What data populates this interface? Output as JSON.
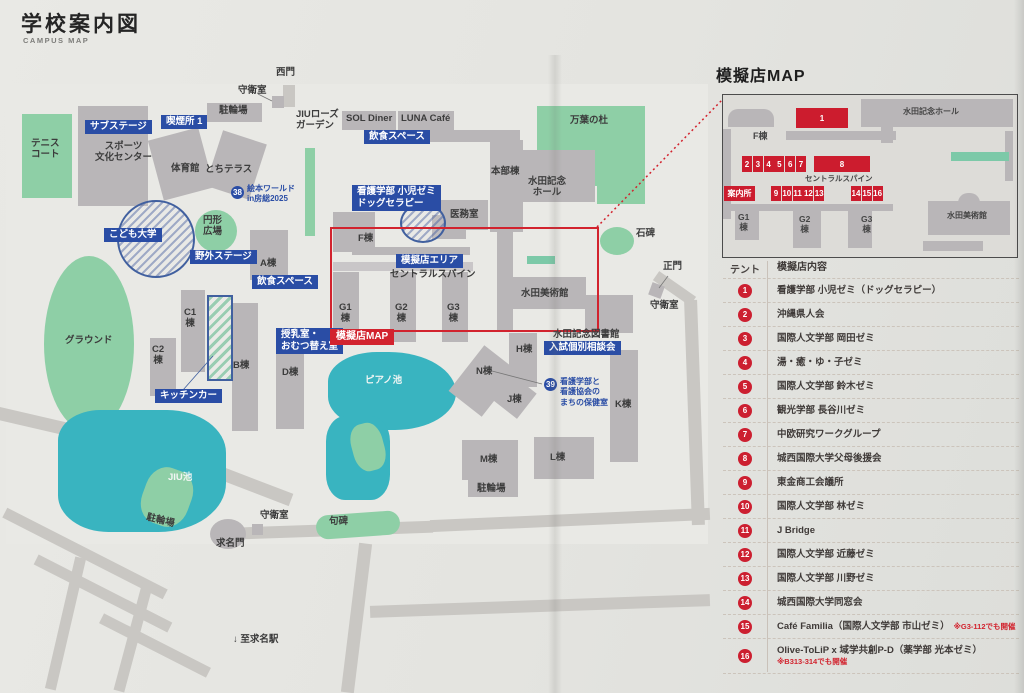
{
  "header": {
    "title": "学校案内図",
    "subtitle": "CAMPUS MAP"
  },
  "colors": {
    "accent_red": "#d2232e",
    "label_blue": "#2a4da5",
    "building_gray": "#b9b6b8",
    "green": "#8ecfa6",
    "pond_teal": "#39b4c0"
  },
  "map": {
    "t": [
      "西門",
      "守衛室",
      "駐輪場",
      "JIUローズ\nガーデン",
      "SOL Diner",
      "LUNA Café",
      "万葉の杜",
      "本部棟",
      "水田記念\nホール",
      "医務室",
      "テニス\nコート",
      "スポーツ\n文化センター",
      "体育館",
      "とちテラス",
      "円形\n広場",
      "A棟",
      "F棟",
      "セントラルスパイン",
      "G1\n棟",
      "G2\n棟",
      "G3\n棟",
      "水田美術館",
      "石碑",
      "正門",
      "守衛室",
      "水田記念図書館",
      "H棟",
      "C1\n棟",
      "C2\n棟",
      "B棟",
      "D棟",
      "グラウンド",
      "ピアノ池",
      "N棟",
      "J棟",
      "K棟",
      "M棟",
      "L棟",
      "駐輪場",
      "JIU池",
      "駐輪場",
      "守衛室",
      "求名門",
      "句碑",
      "↓ 至求名駅"
    ],
    "blue": [
      "サブステージ",
      "喫煙所 1",
      "飲食スペース",
      "看護学部 小児ゼミ\nドッグセラピー",
      "こども大学",
      "野外ステージ",
      "飲食スペース",
      "模擬店エリア",
      "授乳室・\nおむつ替え室",
      "キッチンカー",
      "入試個別相談会"
    ],
    "rl": "模擬店MAP",
    "b38": {
      "num": "38",
      "text": "絵本ワールド\nin房総2025"
    },
    "b39": {
      "num": "39",
      "text": "看護学部と\n看護協会の\nまちの保健室"
    }
  },
  "panel": {
    "title": "模擬店MAP"
  },
  "inset": {
    "hall": "水田記念ホール",
    "f": "F棟",
    "spine": "セントラルスパイン",
    "info": "案内所",
    "museum": "水田美術館",
    "g1": "G1\n棟",
    "g2": "G2\n棟",
    "g3": "G3\n棟",
    "nums": [
      "1",
      "2",
      "3",
      "4",
      "5",
      "6",
      "7",
      "8",
      "9",
      "10",
      "11",
      "12",
      "13",
      "14",
      "15",
      "16"
    ]
  },
  "stalls": {
    "header_tent": "テント",
    "header_content": "模擬店内容",
    "items": [
      {
        "num": "1",
        "name": "看護学部 小児ゼミ（ドッグセラピー）",
        "note": ""
      },
      {
        "num": "2",
        "name": "沖縄県人会",
        "note": ""
      },
      {
        "num": "3",
        "name": "国際人文学部 岡田ゼミ",
        "note": ""
      },
      {
        "num": "4",
        "name": "湯・癒・ゆ・子ゼミ",
        "note": ""
      },
      {
        "num": "5",
        "name": "国際人文学部 鈴木ゼミ",
        "note": ""
      },
      {
        "num": "6",
        "name": "観光学部 長谷川ゼミ",
        "note": ""
      },
      {
        "num": "7",
        "name": "中欧研究ワークグループ",
        "note": ""
      },
      {
        "num": "8",
        "name": "城西国際大学父母後援会",
        "note": ""
      },
      {
        "num": "9",
        "name": "東金商工会議所",
        "note": ""
      },
      {
        "num": "10",
        "name": "国際人文学部 林ゼミ",
        "note": ""
      },
      {
        "num": "11",
        "name": "J Bridge",
        "note": ""
      },
      {
        "num": "12",
        "name": "国際人文学部 近藤ゼミ",
        "note": ""
      },
      {
        "num": "13",
        "name": "国際人文学部 川野ゼミ",
        "note": ""
      },
      {
        "num": "14",
        "name": "城西国際大学同窓会",
        "note": ""
      },
      {
        "num": "15",
        "name": "Café Familia（国際人文学部 市山ゼミ）",
        "note": "※G3-112でも開催"
      },
      {
        "num": "16",
        "name": "Olive-ToLiP x 域学共創P-D（薬学部 光本ゼミ）",
        "note": "※B313-314でも開催"
      }
    ]
  }
}
